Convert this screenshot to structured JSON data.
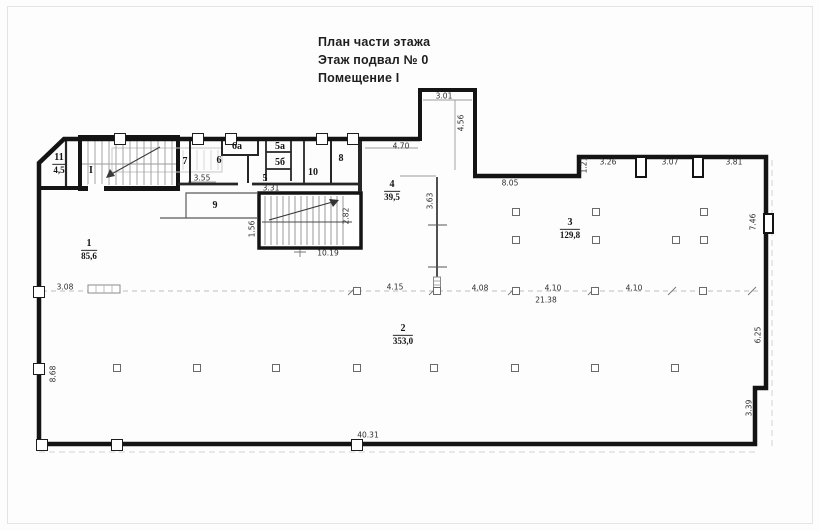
{
  "title": {
    "line1": "План части этажа",
    "line2": "Этаж подвал № 0",
    "line3": "Помещение I"
  },
  "colors": {
    "wall": "#141414",
    "partition": "#2b2b2b",
    "thin_line": "#999999",
    "dashed_line": "#bdbdbd",
    "text": "#1e1e1e",
    "paper": "#fdfdfd"
  },
  "rooms": [
    {
      "number": "11",
      "area": "4,5",
      "x": 59,
      "y": 164
    },
    {
      "number": "I",
      "area": "",
      "x": 91,
      "y": 171
    },
    {
      "number": "7",
      "area": "",
      "x": 185,
      "y": 162
    },
    {
      "number": "6а",
      "area": "",
      "x": 237,
      "y": 147
    },
    {
      "number": "6",
      "area": "",
      "x": 219,
      "y": 161
    },
    {
      "number": "5а",
      "area": "",
      "x": 280,
      "y": 147
    },
    {
      "number": "5б",
      "area": "",
      "x": 280,
      "y": 163
    },
    {
      "number": "5",
      "area": "",
      "x": 265,
      "y": 179
    },
    {
      "number": "10",
      "area": "",
      "x": 313,
      "y": 173
    },
    {
      "number": "8",
      "area": "",
      "x": 341,
      "y": 159
    },
    {
      "number": "9",
      "area": "",
      "x": 215,
      "y": 206
    },
    {
      "number": "4",
      "area": "39,5",
      "x": 392,
      "y": 191
    },
    {
      "number": "3",
      "area": "129,8",
      "x": 570,
      "y": 229
    },
    {
      "number": "1",
      "area": "85,6",
      "x": 89,
      "y": 250
    },
    {
      "number": "2",
      "area": "353,0",
      "x": 403,
      "y": 335
    }
  ],
  "dims": [
    {
      "t": "3.01",
      "x": 444,
      "y": 96
    },
    {
      "t": "4.56",
      "x": 461,
      "y": 123,
      "v": 1
    },
    {
      "t": "4.70",
      "x": 401,
      "y": 146
    },
    {
      "t": "8.05",
      "x": 510,
      "y": 183
    },
    {
      "t": "1.21",
      "x": 584,
      "y": 165,
      "v": 1
    },
    {
      "t": "3.26",
      "x": 608,
      "y": 162
    },
    {
      "t": "3.07",
      "x": 670,
      "y": 162
    },
    {
      "t": "3.81",
      "x": 734,
      "y": 162
    },
    {
      "t": "7.46",
      "x": 753,
      "y": 222,
      "v": 1
    },
    {
      "t": "3.55",
      "x": 202,
      "y": 178
    },
    {
      "t": "3.31",
      "x": 271,
      "y": 188
    },
    {
      "t": "2.82",
      "x": 346,
      "y": 216,
      "v": 1
    },
    {
      "t": "1.56",
      "x": 252,
      "y": 229,
      "v": 1
    },
    {
      "t": "10.19",
      "x": 328,
      "y": 253
    },
    {
      "t": "3.63",
      "x": 430,
      "y": 201,
      "v": 1
    },
    {
      "t": "3.08",
      "x": 65,
      "y": 287
    },
    {
      "t": "4.15",
      "x": 395,
      "y": 287
    },
    {
      "t": "4.08",
      "x": 480,
      "y": 288
    },
    {
      "t": "4.10",
      "x": 553,
      "y": 288
    },
    {
      "t": "4.10",
      "x": 634,
      "y": 288
    },
    {
      "t": "21.38",
      "x": 546,
      "y": 300
    },
    {
      "t": "8.68",
      "x": 53,
      "y": 374,
      "v": 1
    },
    {
      "t": "6.25",
      "x": 758,
      "y": 335,
      "v": 1
    },
    {
      "t": "3.39",
      "x": 749,
      "y": 408,
      "v": 1
    },
    {
      "t": "40.31",
      "x": 368,
      "y": 435
    }
  ],
  "columns": [
    [
      357,
      291
    ],
    [
      437,
      291
    ],
    [
      516,
      291
    ],
    [
      595,
      291
    ],
    [
      703,
      291
    ],
    [
      516,
      212
    ],
    [
      596,
      212
    ],
    [
      704,
      212
    ],
    [
      516,
      240
    ],
    [
      596,
      240
    ],
    [
      676,
      240
    ],
    [
      704,
      240
    ],
    [
      117,
      368
    ],
    [
      197,
      368
    ],
    [
      276,
      368
    ],
    [
      357,
      368
    ],
    [
      434,
      368
    ],
    [
      515,
      368
    ],
    [
      595,
      368
    ],
    [
      675,
      368
    ]
  ],
  "wall_squares": [
    [
      120,
      139
    ],
    [
      198,
      139
    ],
    [
      231,
      139
    ],
    [
      322,
      139
    ],
    [
      353,
      139
    ],
    [
      39,
      292
    ],
    [
      39,
      369
    ],
    [
      42,
      445
    ],
    [
      117,
      445
    ],
    [
      357,
      445
    ]
  ]
}
